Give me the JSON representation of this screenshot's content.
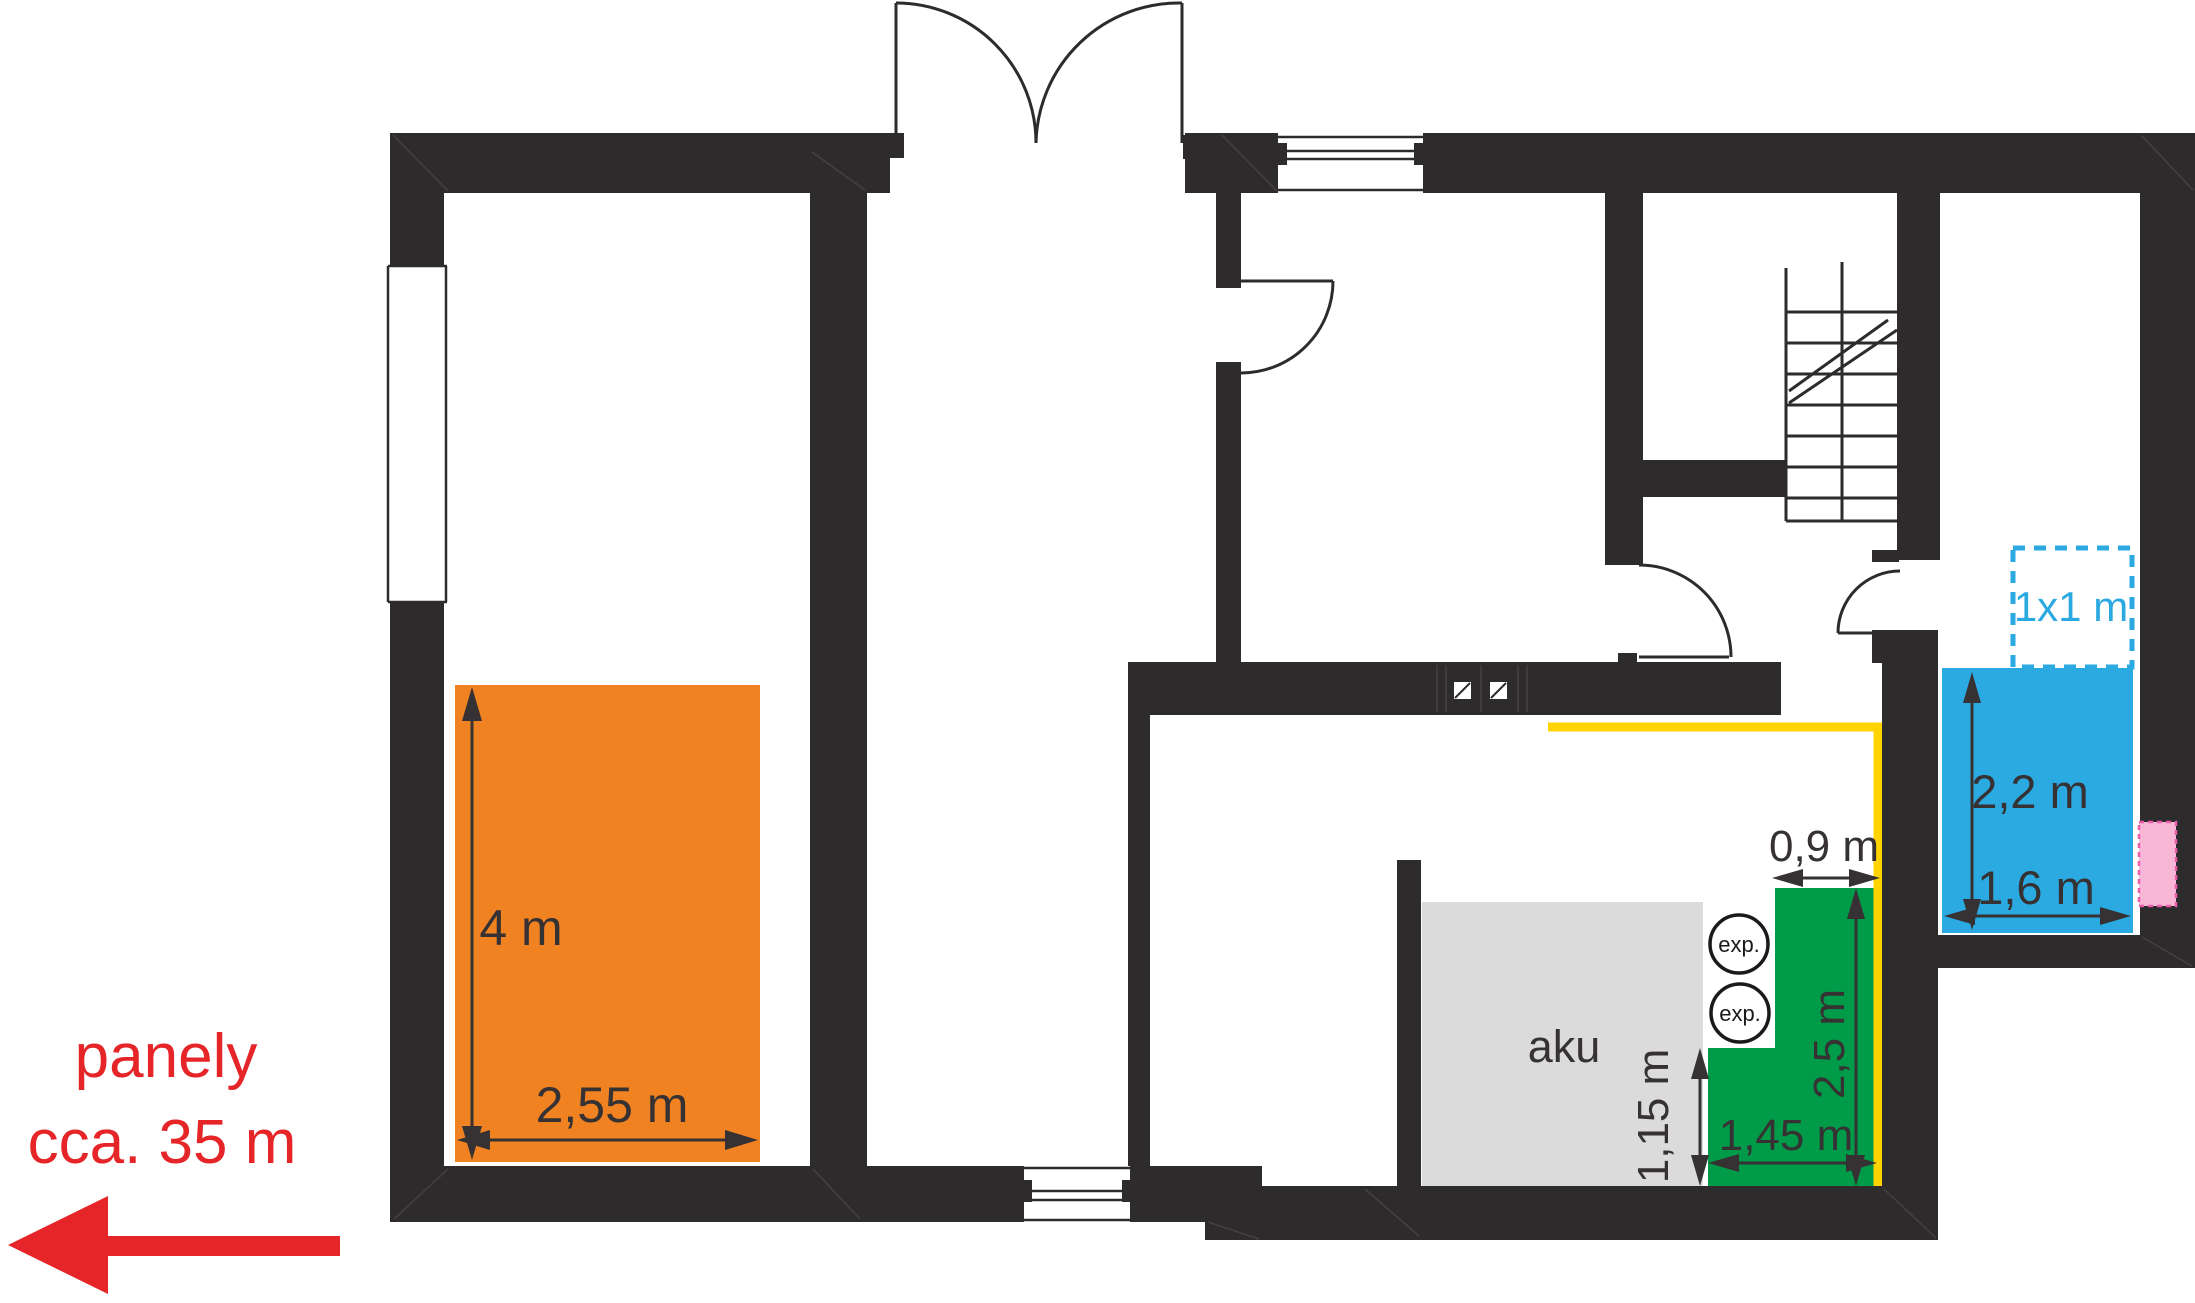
{
  "annotation": {
    "line1": "panely",
    "line2": "cca. 35 m"
  },
  "areas": {
    "aku_label": "aku",
    "exp_label": "exp.",
    "dashed_label": "1x1 m"
  },
  "dimensions": {
    "orange_height": "4 m",
    "orange_width": "2,55 m",
    "green_top_width": "0,9 m",
    "green_height": "2,5 m",
    "green_bottom_width": "1,45 m",
    "green_left_height": "1,15 m",
    "blue_height": "2,2 m",
    "blue_width": "1,6 m"
  },
  "colors": {
    "wall": "#2E2B2C",
    "orange": "#F08222",
    "green": "#009B48",
    "blue": "#2BA9E1",
    "yellow": "#FFD400",
    "gray": "#DBDBDB",
    "pink": "#F8B7D7",
    "pink_border": "#EA5EA9",
    "red": "#E52528",
    "dim_text": "#363233"
  }
}
